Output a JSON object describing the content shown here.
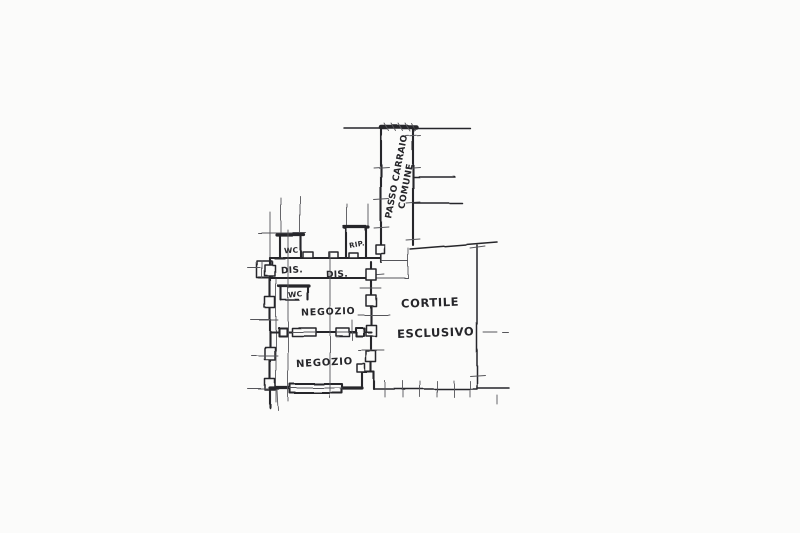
{
  "colors": {
    "paper": "#fbfbfa",
    "ink": "#26262a",
    "ink_light": "#55555a"
  },
  "plan": {
    "labels": {
      "wc_top": "WC",
      "rip": "RIP.",
      "dis_left": "DIS.",
      "dis_center": "DIS.",
      "wc_lower": "WC",
      "negozio_upper": "NEGOZIO",
      "negozio_lower": "NEGOZIO",
      "cortile_line1": "CORTILE",
      "cortile_line2": "ESCLUSIVO",
      "passo_line1": "PASSO CARRAIO",
      "passo_line2": "COMUNE"
    }
  }
}
